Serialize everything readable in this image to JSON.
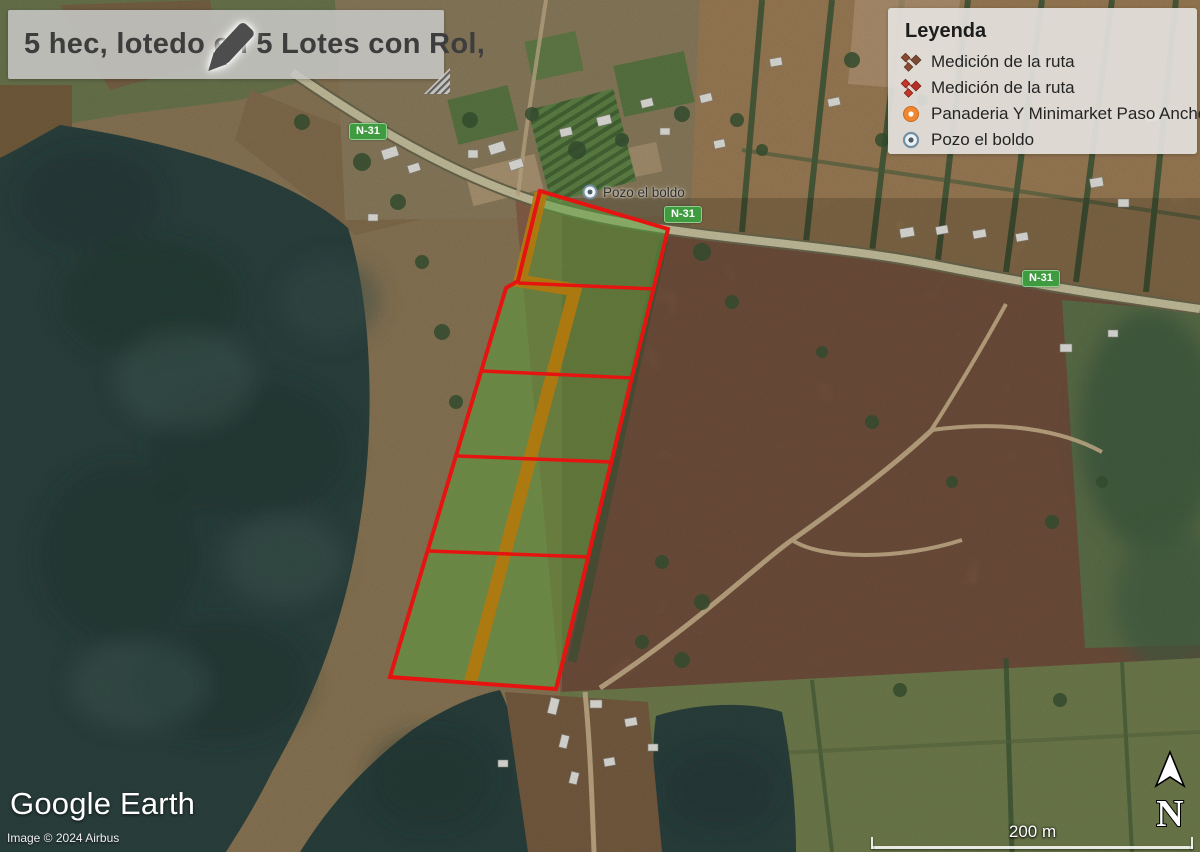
{
  "banner": {
    "title": "5 hec, lotedo en 5 Lotes con Rol,"
  },
  "legend": {
    "title": "Leyenda",
    "items": [
      {
        "label": "Medición de la ruta",
        "icon": "route-measure-icon",
        "color": "#8a4a32"
      },
      {
        "label": "Medición de la ruta",
        "icon": "route-measure-icon",
        "color": "#c5352c"
      },
      {
        "label": "Panaderia Y Minimarket Paso Ancho",
        "icon": "poi-circle-icon",
        "color": "#f08632"
      },
      {
        "label": "Pozo el boldo",
        "icon": "well-circle-icon",
        "color": "#7290a5"
      }
    ]
  },
  "map": {
    "place_label": "Pozo el boldo",
    "route_badge": "N-31",
    "parcel": {
      "lots": 5,
      "fill_color": "#58a23c",
      "border_color": "#e61410",
      "road_color": "#b0790f"
    }
  },
  "footer": {
    "logo": "Google Earth",
    "attribution": "Image © 2024 Airbus"
  },
  "scalebar": {
    "label": "200 m"
  },
  "compass": {
    "label": "N"
  }
}
